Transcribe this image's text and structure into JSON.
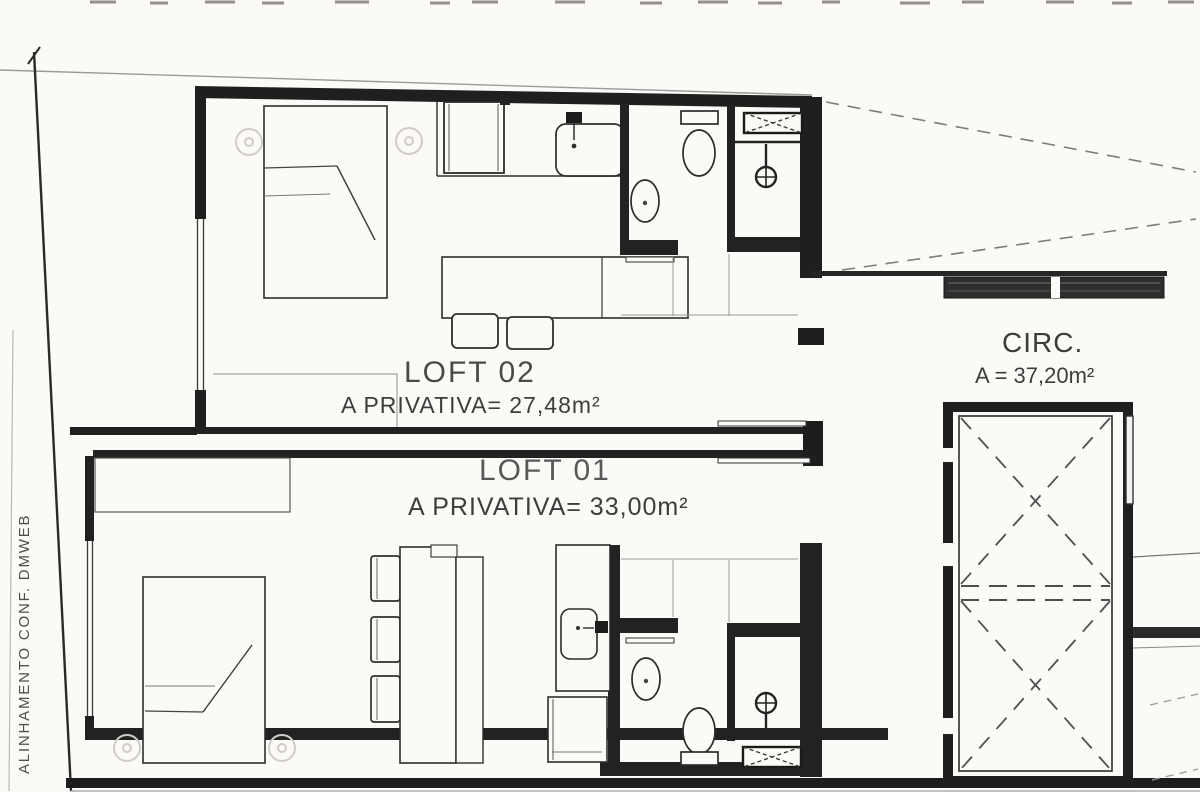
{
  "labels": {
    "loft02": {
      "name": "LOFT 02",
      "area": "A PRIVATIVA= 27,48m²"
    },
    "loft01": {
      "name": "LOFT 01",
      "area": "A PRIVATIVA= 33,00m²"
    },
    "circulation": {
      "name": "CIRC.",
      "area": "A = 37,20m²"
    },
    "boundary_note": "ALINHAMENTO CONF. DMWEB"
  },
  "colors": {
    "paper": "#fbfaf7",
    "ink": "#1f1f1f",
    "ink_medium": "#444444",
    "ink_light": "#8a8a8a",
    "label_gray": "#4a4a4a"
  },
  "fixtures": {
    "loft02": [
      "ceiling-light",
      "bed",
      "upper-cabinet",
      "kitchen-counter",
      "kitchen-sink",
      "dining-table",
      "chair",
      "toilet",
      "washbasin",
      "shower-head",
      "ventilation-duct",
      "sliding-door-track",
      "window"
    ],
    "loft01": [
      "ceiling-light",
      "bed",
      "wardrobe",
      "chair",
      "dining-table",
      "kitchen-counter",
      "kitchen-sink",
      "cooktop",
      "washbasin",
      "toilet",
      "shower-head",
      "ventilation-duct",
      "sliding-door-track",
      "window"
    ],
    "circulation": [
      "elevator-shaft",
      "door-leaf",
      "hatched-wall"
    ]
  }
}
